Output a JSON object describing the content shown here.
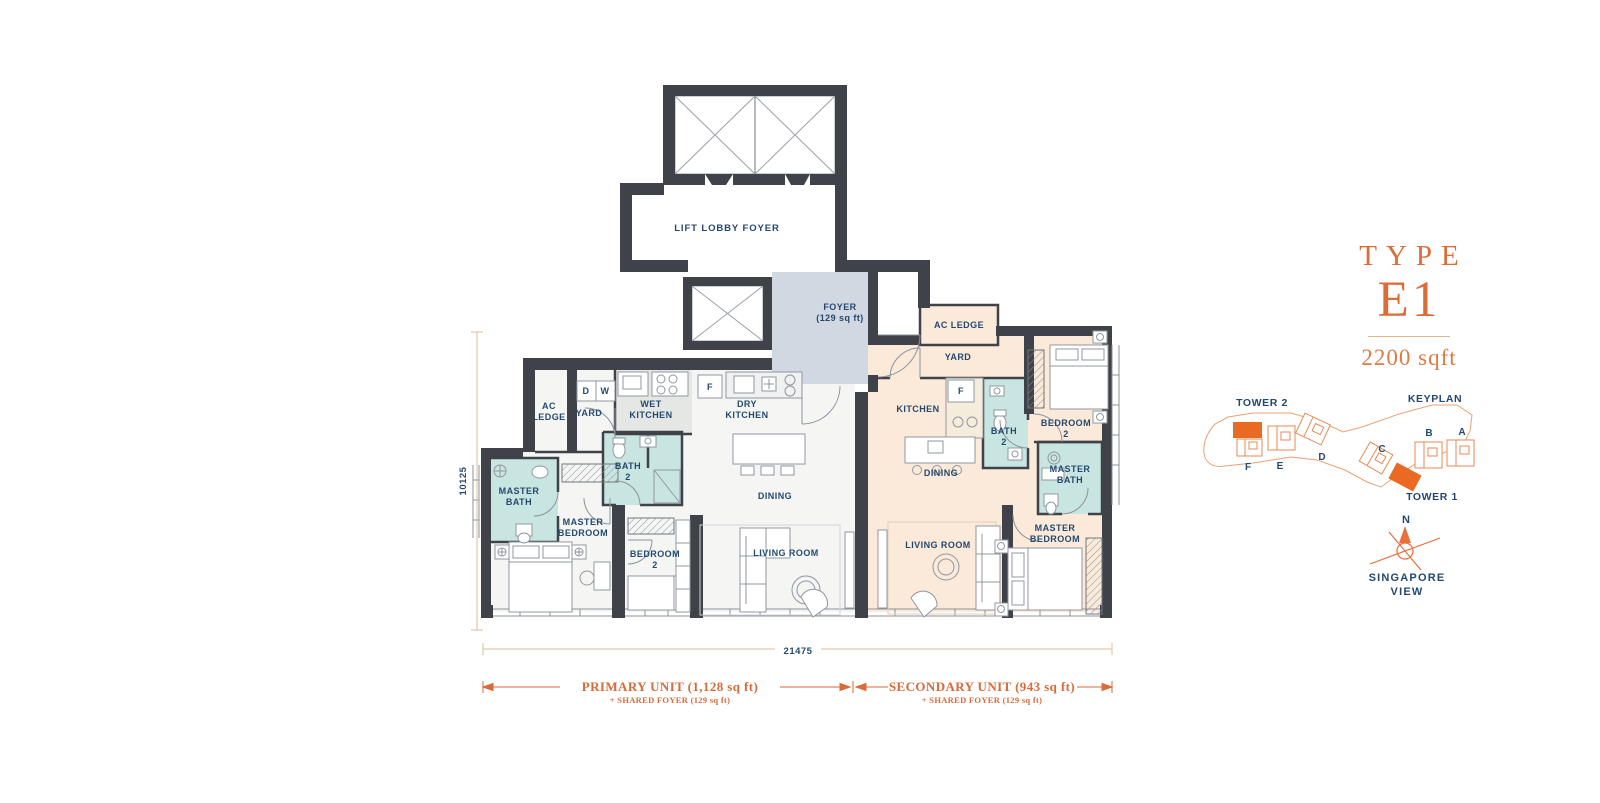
{
  "title": {
    "type_label": "TYPE",
    "type_code": "E1",
    "area": "2200 sqft"
  },
  "keyplan": {
    "heading": "KEYPLAN",
    "tower2_label": "TOWER 2",
    "tower1_label": "TOWER 1",
    "units": [
      "F",
      "E",
      "D",
      "C",
      "B",
      "A"
    ],
    "compass_north": "N",
    "view_line1": "SINGAPORE",
    "view_line2": "VIEW"
  },
  "plan": {
    "lift_lobby_label": "LIFT LOBBY FOYER",
    "foyer_label": "FOYER",
    "foyer_area": "(129 sq ft)",
    "primary": {
      "ac_ledge_line1": "AC",
      "ac_ledge_line2": "LEDGE",
      "yard": "YARD",
      "dryer": "D",
      "washer": "W",
      "wet_kitchen_line1": "WET",
      "wet_kitchen_line2": "KITCHEN",
      "fridge": "F",
      "dry_kitchen_line1": "DRY",
      "dry_kitchen_line2": "KITCHEN",
      "bath2_line1": "BATH",
      "bath2_line2": "2",
      "master_bath_line1": "MASTER",
      "master_bath_line2": "BATH",
      "master_bedroom_line1": "MASTER",
      "master_bedroom_line2": "BEDROOM",
      "bedroom2_line1": "BEDROOM",
      "bedroom2_line2": "2",
      "dining": "DINING",
      "living_room": "LIVING ROOM"
    },
    "secondary": {
      "ac_ledge": "AC LEDGE",
      "yard": "YARD",
      "kitchen": "KITCHEN",
      "fridge": "F",
      "bath2_line1": "BATH",
      "bath2_line2": "2",
      "bedroom2_line1": "BEDROOM",
      "bedroom2_line2": "2",
      "master_bath_line1": "MASTER",
      "master_bath_line2": "BATH",
      "dining": "DINING",
      "living_room": "LIVING ROOM",
      "master_bedroom_line1": "MASTER",
      "master_bedroom_line2": "BEDROOM"
    }
  },
  "dimensions": {
    "overall_width": "21475",
    "overall_height": "10125"
  },
  "legend": {
    "primary_title": "PRIMARY UNIT (1,128 sq ft)",
    "primary_subtitle": "+ SHARED FOYER (129 sq ft)",
    "secondary_title": "SECONDARY UNIT (943 sq ft)",
    "secondary_subtitle": "+ SHARED FOYER (129 sq ft)"
  },
  "colors": {
    "accent_orange": "#DD6B35",
    "keyplan_fill_orange": "#EA6A24",
    "keyplan_outline_orange": "#ECA173",
    "label_navy": "#24496E",
    "wall_dark": "#3F4349",
    "secondary_unit_fill": "#FBEAD9",
    "bathroom_fill": "#C9E5E1",
    "foyer_fill": "#D2D8E2",
    "wet_kitchen_fill": "#E5E7E5",
    "primary_unit_fill": "#F5F6F4",
    "dimension_tan": "#D9BD95"
  }
}
